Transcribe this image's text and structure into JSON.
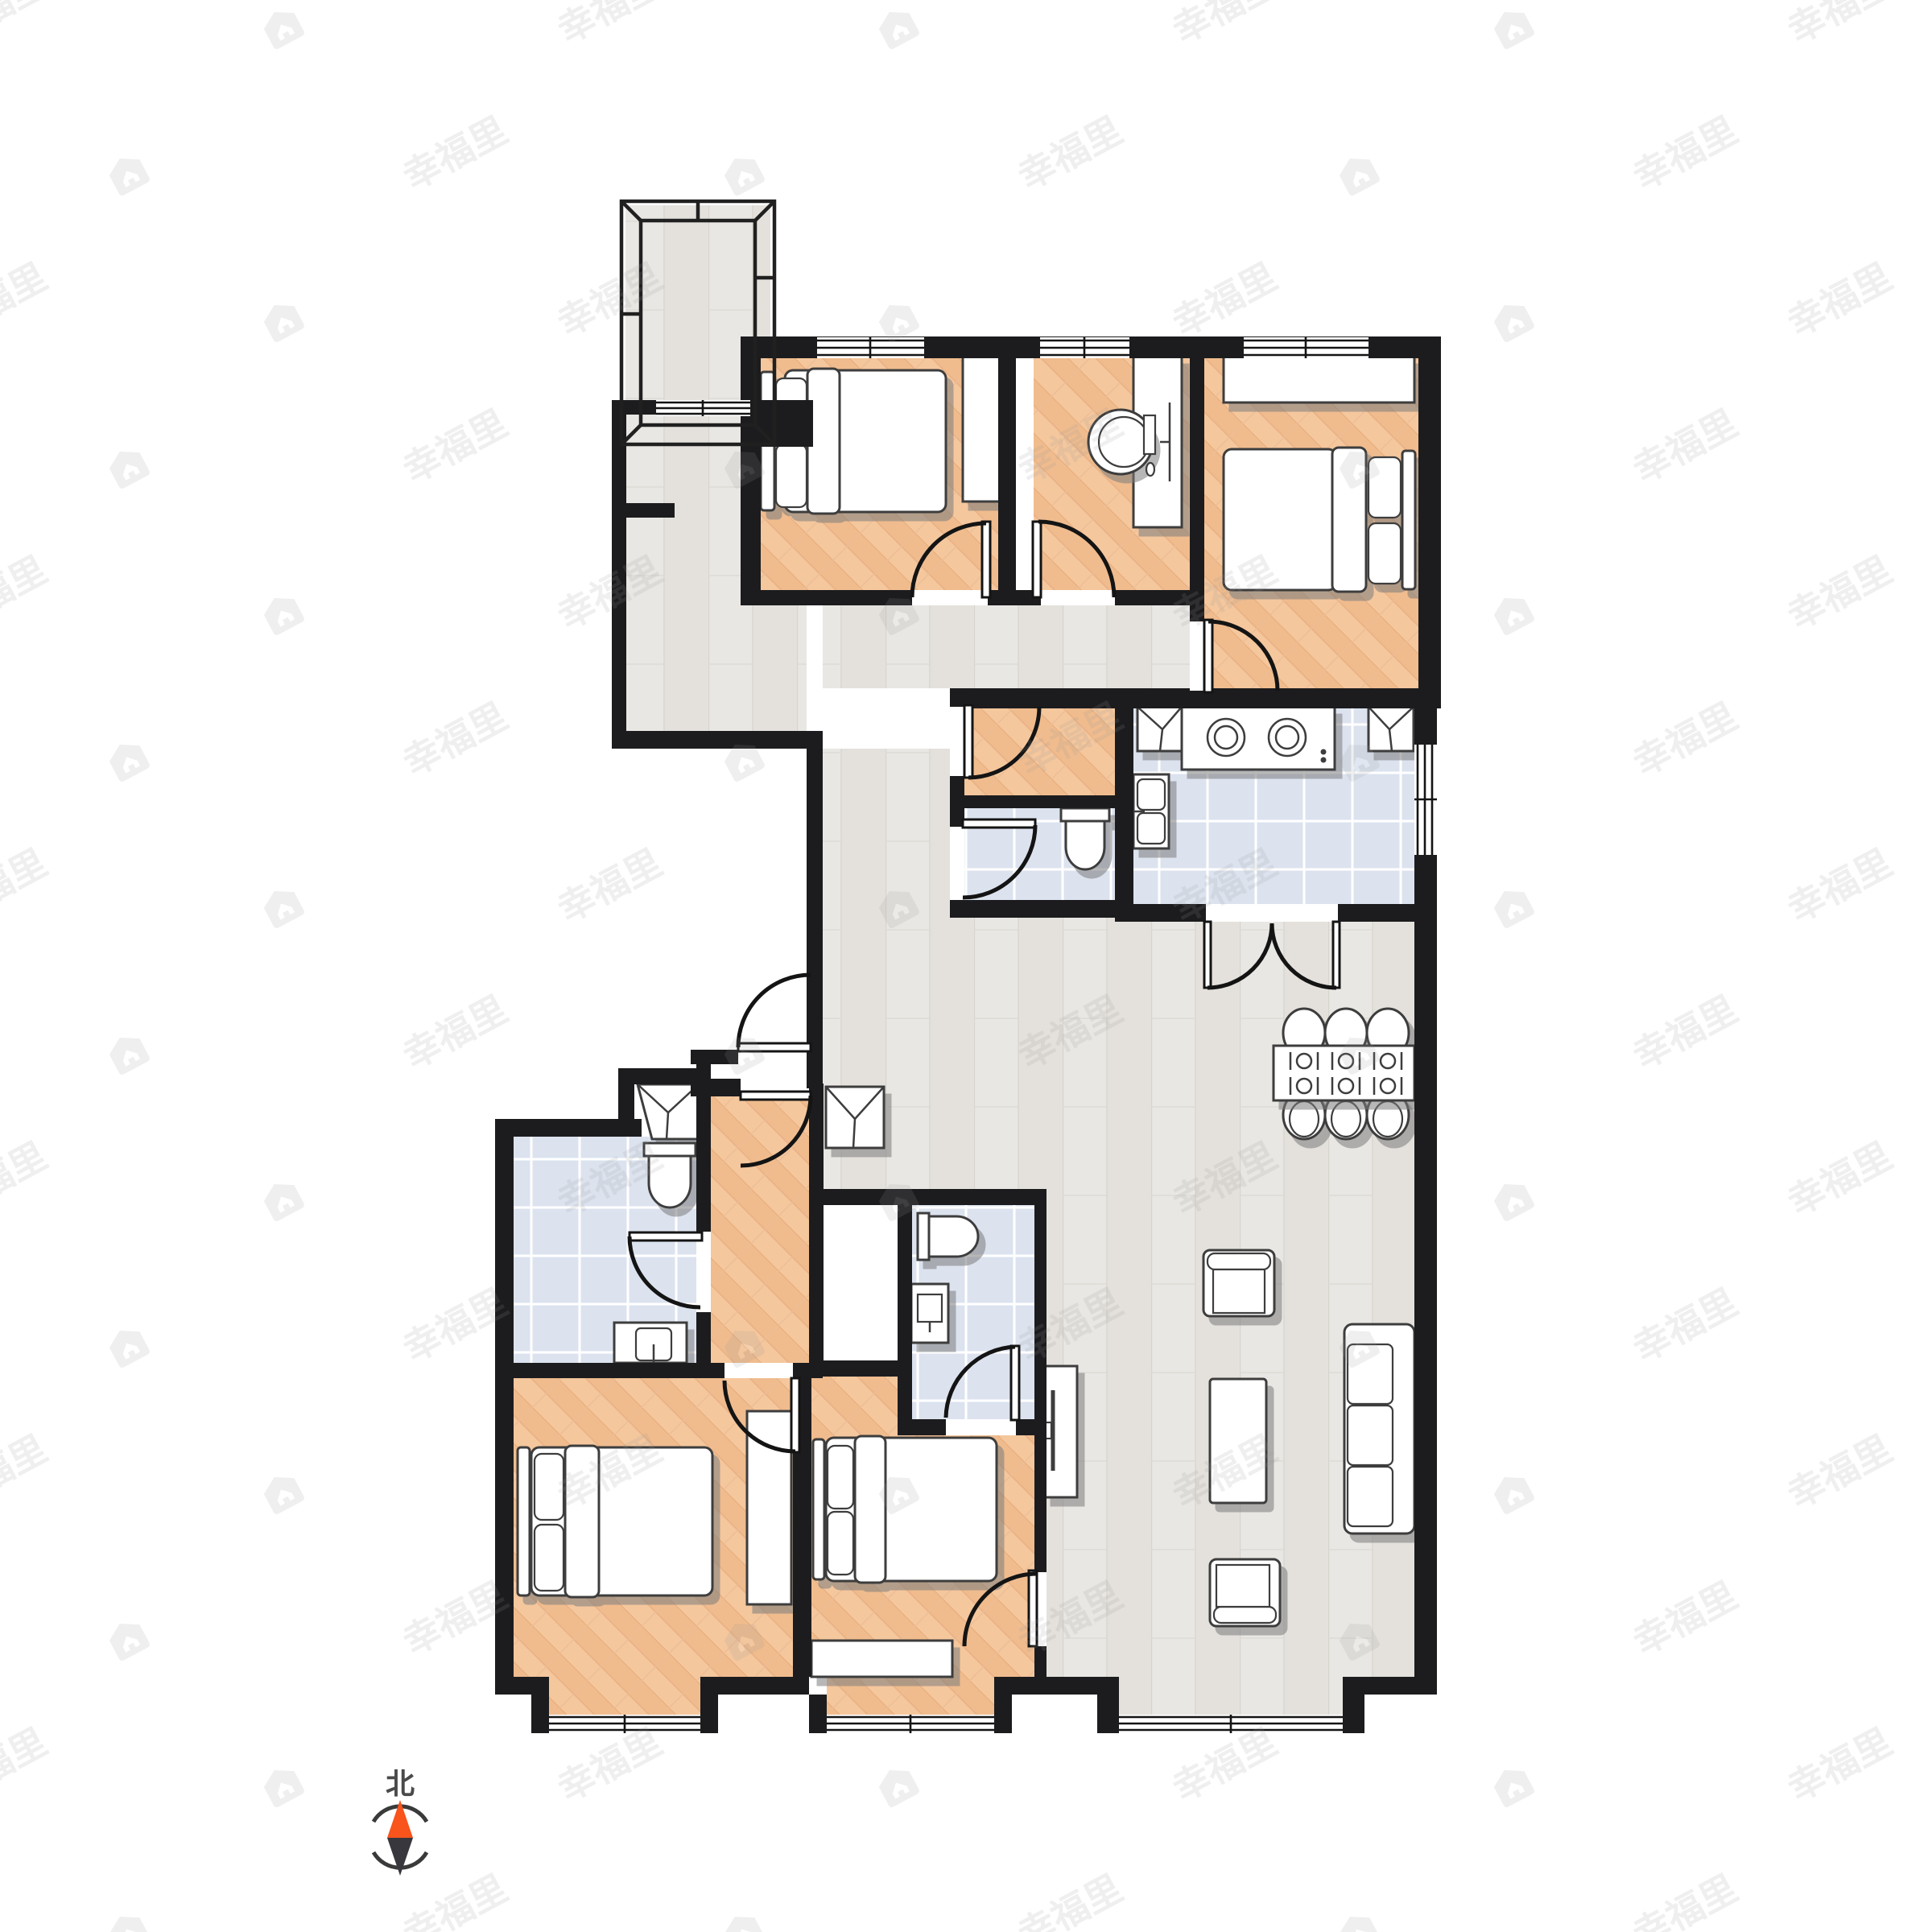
{
  "page": {
    "background": "#ffffff",
    "type": "residential-floor-plan"
  },
  "compass": {
    "label": "北",
    "north_color": "#f8541b",
    "south_color": "#37373d"
  },
  "watermark": {
    "text": "幸福里",
    "color": "#9a9a9a",
    "opacity": 0.16
  },
  "palette": {
    "wall": "#1c1c1e",
    "wood_warm": "#f5c79d",
    "wood_light": "#e9e7e3",
    "tile": "#dce3ef",
    "furniture_stroke": "#3d3d3d",
    "furniture_fill": "#ffffff"
  },
  "rooms": [
    {
      "id": "balcony-north",
      "floor": "wood_light",
      "furniture": []
    },
    {
      "id": "corridor-north",
      "floor": "wood_light",
      "furniture": []
    },
    {
      "id": "bedroom-northwest",
      "floor": "wood_warm",
      "furniture": [
        "double-bed",
        "wardrobe"
      ]
    },
    {
      "id": "study",
      "floor": "wood_warm",
      "furniture": [
        "desk",
        "chair",
        "monitor"
      ]
    },
    {
      "id": "bedroom-northeast",
      "floor": "wood_warm",
      "furniture": [
        "wardrobe",
        "double-bed"
      ]
    },
    {
      "id": "kitchen",
      "floor": "tile",
      "furniture": [
        "corner-counter",
        "cooktop",
        "corner-counter",
        "double-sink",
        "double-swing-door"
      ]
    },
    {
      "id": "pantry",
      "floor": "wood_warm",
      "furniture": []
    },
    {
      "id": "bathroom-central",
      "floor": "tile",
      "furniture": [
        "toilet"
      ]
    },
    {
      "id": "entry",
      "floor": "none",
      "furniture": [
        "entry-doors",
        "shoe-cabinet"
      ]
    },
    {
      "id": "living-dining-room",
      "floor": "wood_light",
      "furniture": [
        "dining-table",
        "six-chairs",
        "armchair",
        "coffee-table",
        "sofa",
        "armchair",
        "tv-stand"
      ]
    },
    {
      "id": "hallway-south",
      "floor": "wood_warm",
      "furniture": []
    },
    {
      "id": "bathroom-west",
      "floor": "tile",
      "furniture": [
        "corner-sink",
        "toilet",
        "washing-machine"
      ]
    },
    {
      "id": "master-bedroom",
      "floor": "wood_warm",
      "furniture": [
        "double-bed",
        "wardrobe"
      ]
    },
    {
      "id": "bathroom-south",
      "floor": "tile",
      "furniture": [
        "toilet",
        "vanity-sink"
      ]
    },
    {
      "id": "bedroom-south",
      "floor": "wood_warm",
      "furniture": [
        "double-bed",
        "dresser"
      ]
    }
  ]
}
